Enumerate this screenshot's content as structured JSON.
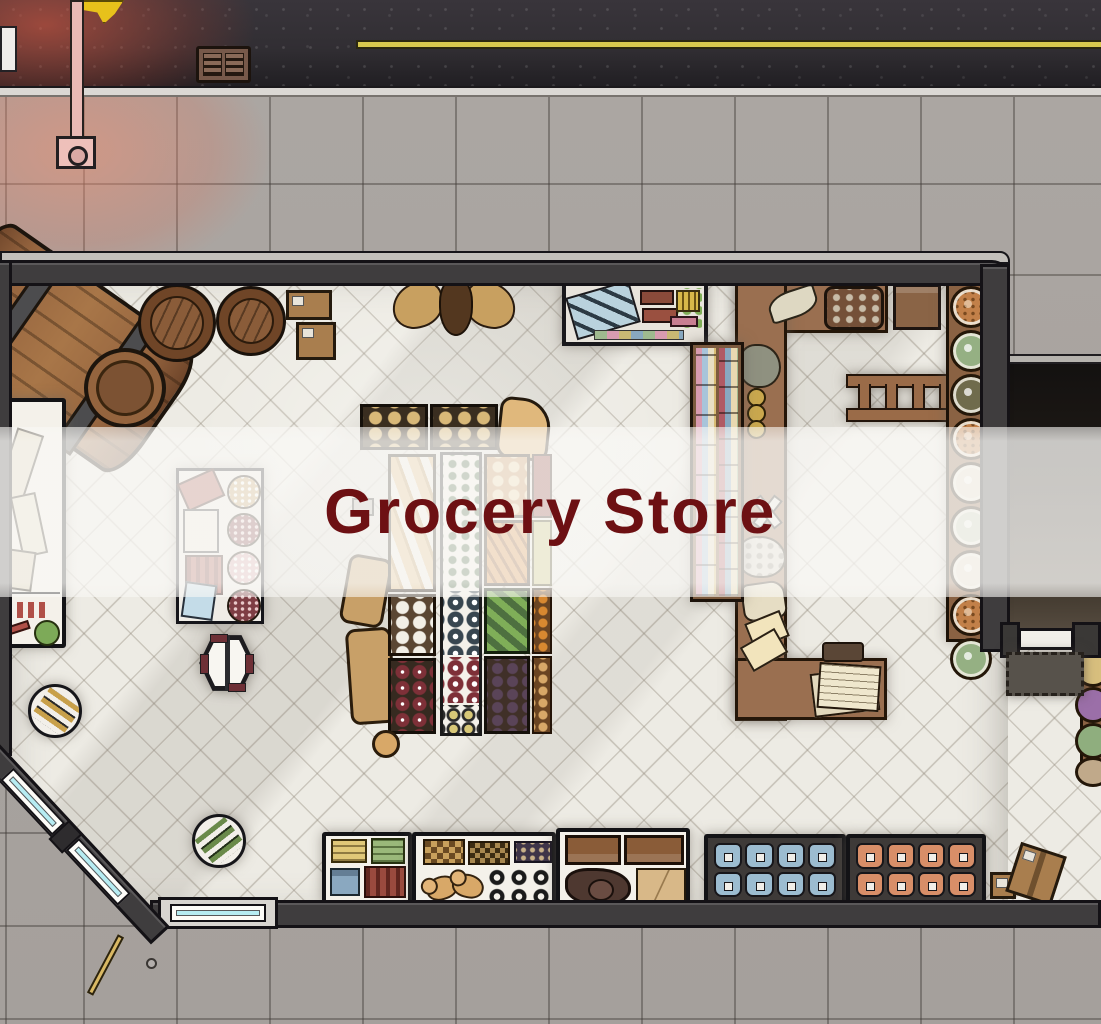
{
  "overlay": {
    "title": "Grocery Store"
  },
  "theme": {
    "title_color": "#6d1013",
    "overlay_band": "rgba(249,248,245,0.78)",
    "floor": "#edebe4",
    "wall": "#3f3d3e",
    "sidewalk": "#a9a4a0",
    "street_line": "#d9c94e",
    "window_glass": "#b6ecf2",
    "counter_wood": "#9a6f50",
    "lamp_glow": "#e9b9b5",
    "flag": "#e7c11b"
  },
  "features": [
    "street",
    "street-center-line",
    "crosswalk-stripe",
    "storm-drain",
    "lamp-post",
    "hanging-flag",
    "sidewalk",
    "store-floor",
    "side-alley",
    "back-door",
    "door-mat",
    "wine-barrel-large",
    "barrel-top-1",
    "barrel-top-2",
    "supply-crates",
    "moose-head-mount",
    "goods-shelf",
    "checkout-counter",
    "checkout-bench",
    "bookshelf",
    "ladder",
    "plate-rack",
    "deli-counter",
    "grain-stand",
    "potato-crates",
    "grocery-sack",
    "produce-stand",
    "loose-onion",
    "toy-shelf",
    "box-shelf",
    "furniture-shelf",
    "blue-jar-case",
    "orange-jar-case",
    "spare-crates",
    "round-table-1",
    "round-table-2",
    "hex-table",
    "diagonal-window-wall",
    "storefront-window",
    "broom"
  ]
}
